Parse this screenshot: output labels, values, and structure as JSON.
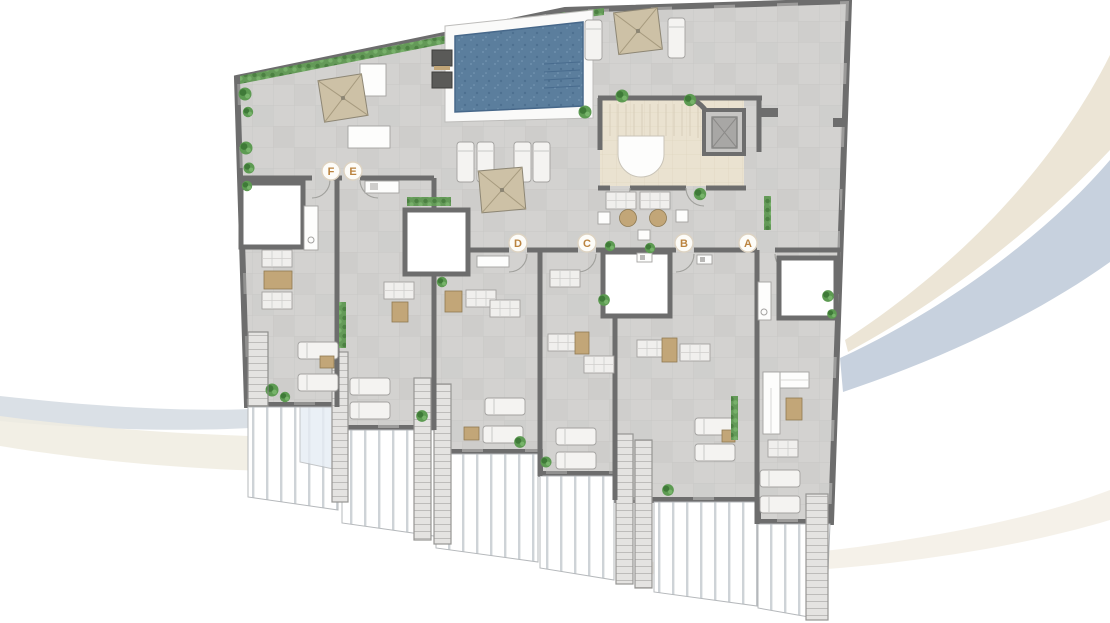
{
  "plan": {
    "unit_badges": [
      {
        "label": "F"
      },
      {
        "label": "E"
      },
      {
        "label": "D"
      },
      {
        "label": "C"
      },
      {
        "label": "B"
      },
      {
        "label": "A"
      }
    ]
  },
  "colors": {
    "wall_gray": "#6d6d6d",
    "floor_tile": "#d3d2d0",
    "pool_water": "#5b7e9d",
    "core_floor": "#eae2d0",
    "umbrella_tan": "#cdc1a6",
    "table_tan": "#c2a678",
    "plant_green": "#5d9b52",
    "badge_letter": "#bb8440",
    "railing_white": "#ffffff",
    "swoosh_beige": "#ece5d6",
    "swoosh_blue": "#c7d1de"
  }
}
